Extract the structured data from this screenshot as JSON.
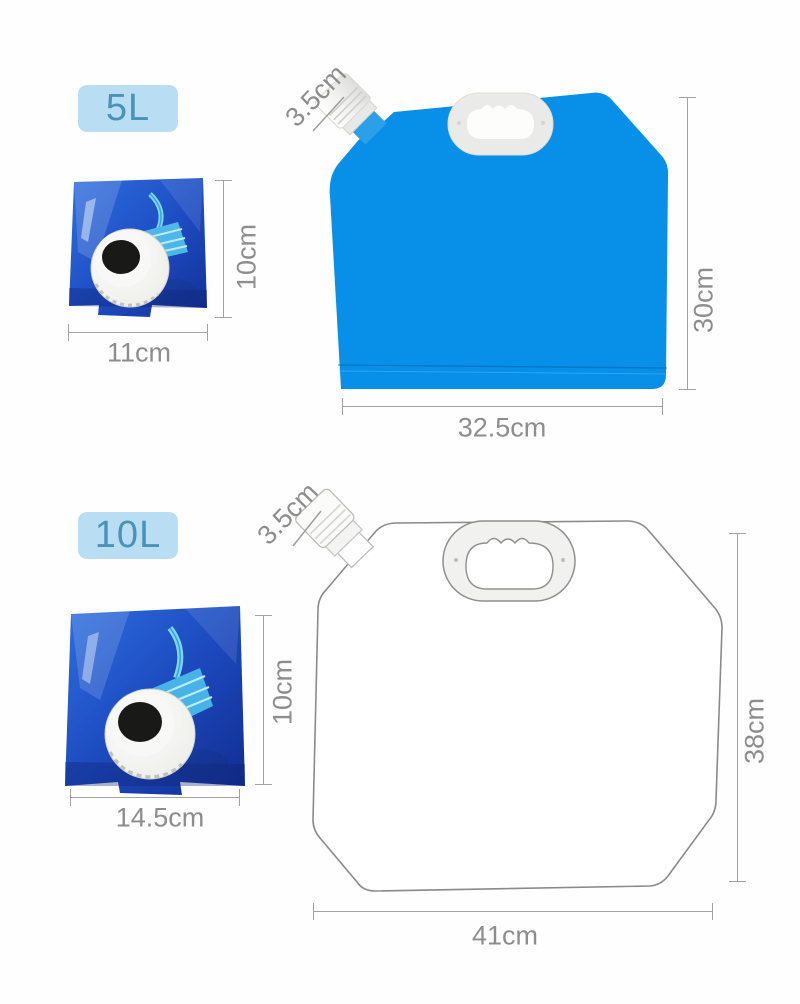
{
  "colors": {
    "bag_blue": "#0890e8",
    "badge_bg": "#b9ddf3",
    "badge_text": "#4a93b8",
    "dimension": "#8d8d8d",
    "outline_gray": "#8a8a8a"
  },
  "sections": [
    {
      "badge": "5L",
      "folded": {
        "width": "11cm",
        "height": "10cm"
      },
      "bag": {
        "spout": "3.5cm",
        "width": "32.5cm",
        "height": "30cm"
      }
    },
    {
      "badge": "10L",
      "folded": {
        "width": "14.5cm",
        "height": "10cm"
      },
      "bag": {
        "spout": "3.5cm",
        "width": "41cm",
        "height": "38cm"
      }
    }
  ]
}
